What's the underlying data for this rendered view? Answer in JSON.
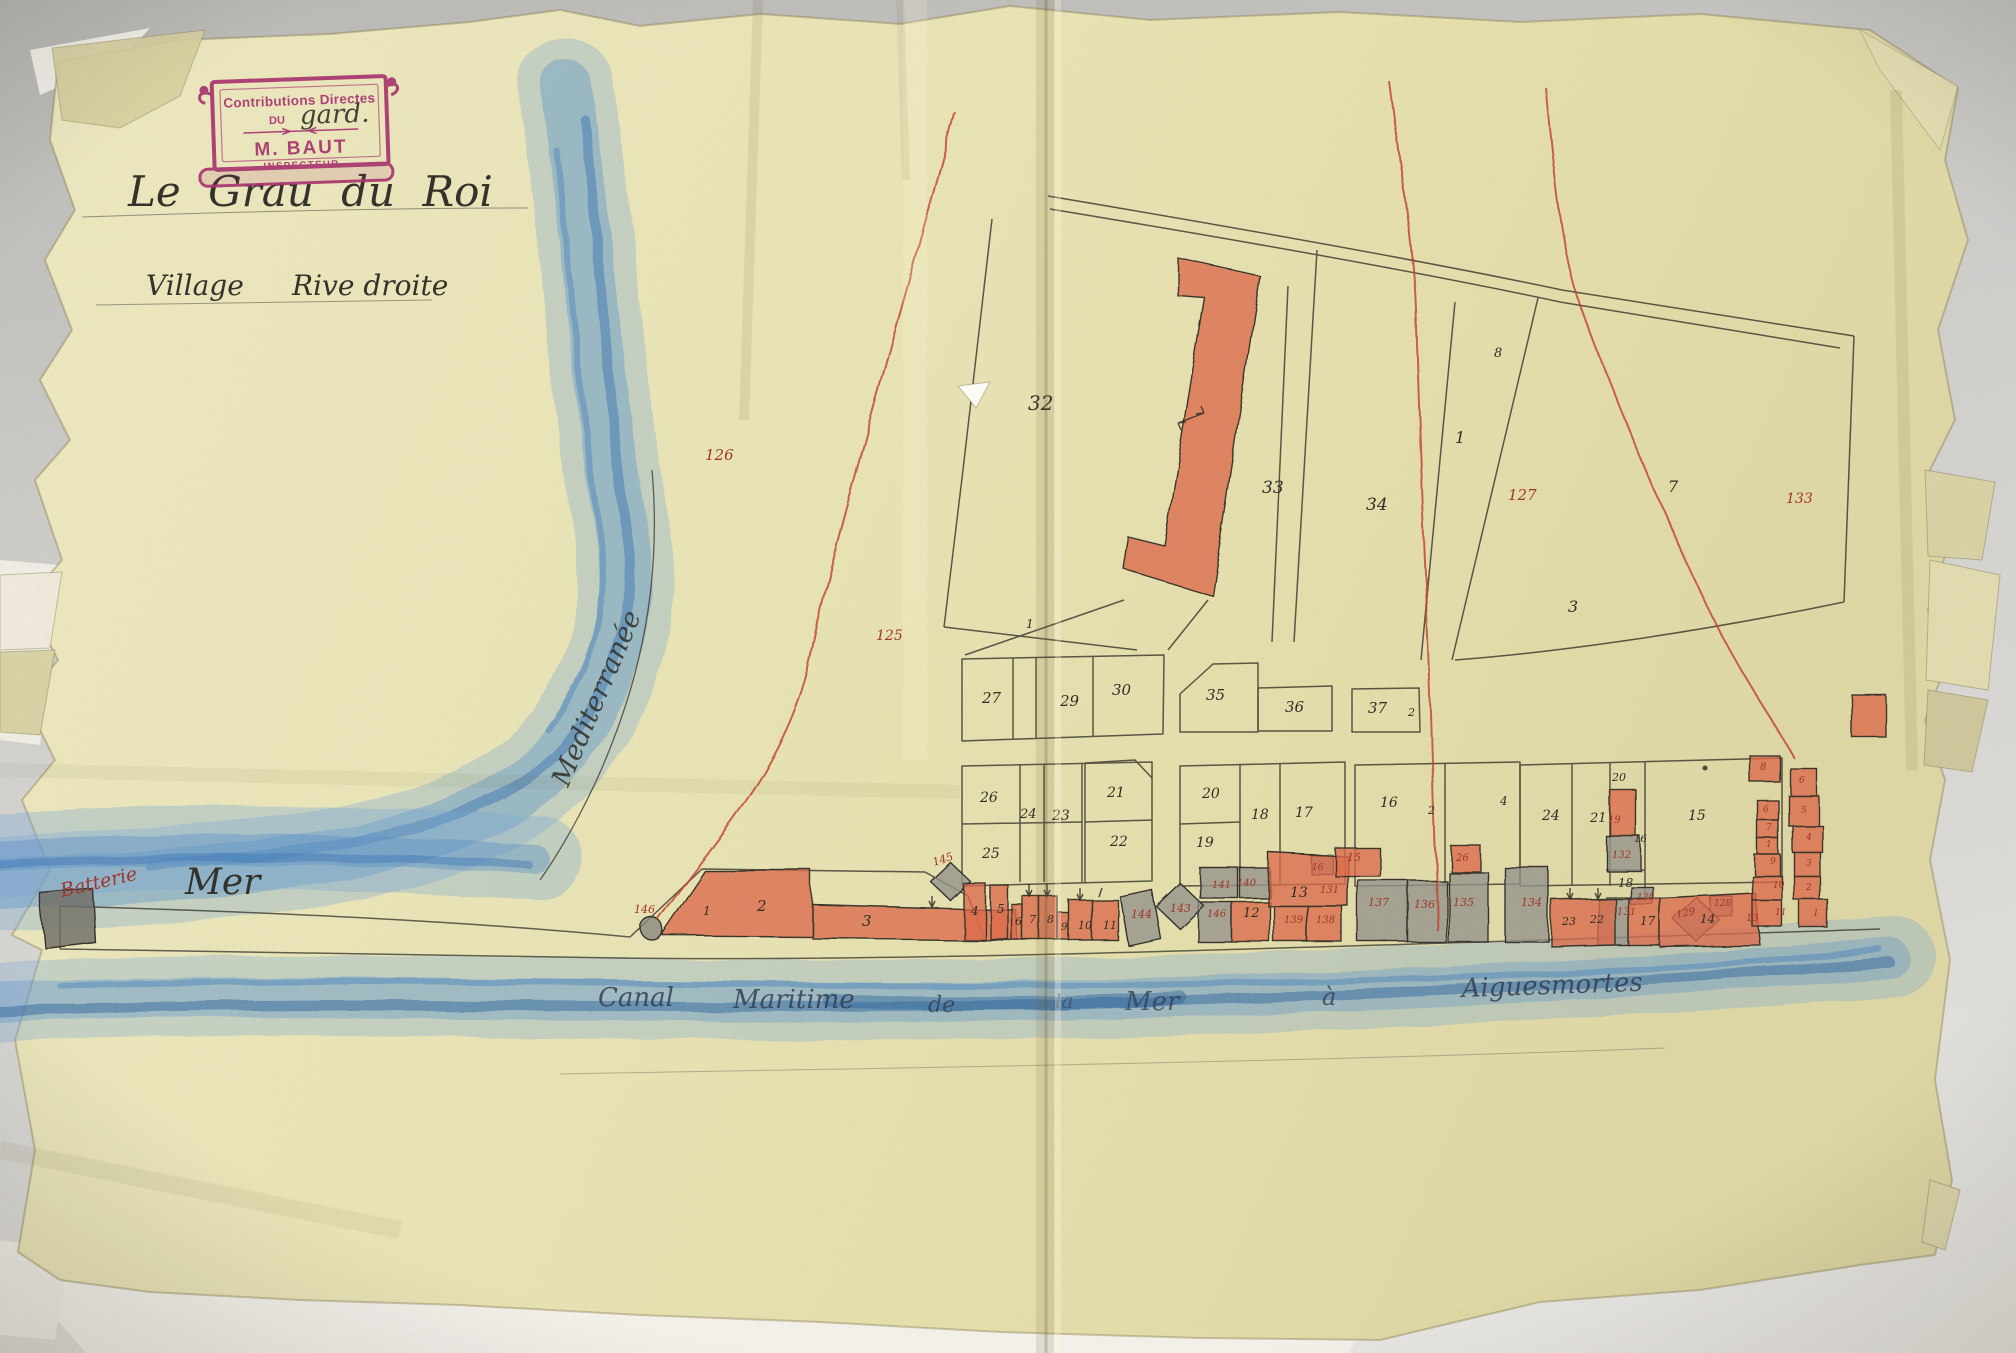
{
  "stamp": {
    "line1": "Contributions Directes",
    "line2_prefix": "DU",
    "line2_handwritten": "gard.",
    "name": "M. BAUT",
    "role": "INSPECTEUR"
  },
  "titles": {
    "place": "Le Grau du Roi",
    "sheet_left": "Village",
    "sheet_right": "Rive droite"
  },
  "water": {
    "mediterranee": "Mediterranée",
    "mer": "Mer",
    "batterie": "Batterie",
    "canal": [
      "Canal",
      "Maritime",
      "de",
      "la",
      "Mer",
      "à",
      "Aiguesmortes"
    ]
  },
  "labels": {
    "black": [
      "32",
      "33",
      "34",
      "1",
      "7",
      "8",
      "3",
      "1",
      "27",
      "29",
      "30",
      "35",
      "36",
      "37",
      "2",
      "26",
      "24",
      "23",
      "21",
      "22",
      "25",
      "20",
      "19",
      "18",
      "17",
      "16",
      "2",
      "4",
      "24",
      "21",
      "20",
      "15",
      "16",
      "18",
      "1",
      "2",
      "3",
      "4",
      "5",
      "6",
      "7",
      "8",
      "9",
      "10",
      "11",
      "12",
      "13",
      "14",
      "17",
      "22",
      "23"
    ],
    "red": [
      "126",
      "125",
      "127",
      "133",
      "146",
      "145",
      "144",
      "143",
      "141",
      "140",
      "146",
      "139",
      "138",
      "131",
      "15",
      "16",
      "26",
      "137",
      "136",
      "135",
      "134",
      "19",
      "132",
      "131",
      "130",
      "129",
      "128",
      "13",
      "8",
      "6",
      "7",
      "1",
      "9",
      "10",
      "11",
      "6",
      "5",
      "4",
      "3",
      "2",
      "1"
    ]
  },
  "colors": {
    "stamp_magenta": "#a8346f",
    "red_ink": "#a23526",
    "red_pencil_fill": "#dd6a4c",
    "blue_pencil": "#5b8fc9",
    "black_ink": "#32322a",
    "paper": "#e8e4b8"
  }
}
